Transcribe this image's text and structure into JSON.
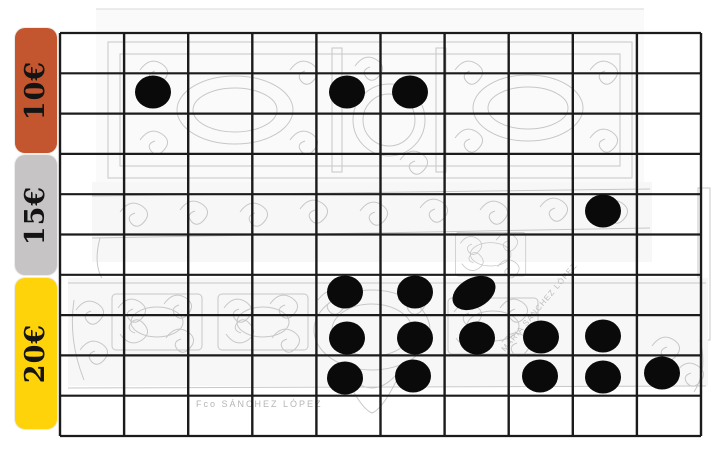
{
  "board": {
    "description": "Price grid board with black token markers placed over faded antique furniture drawings",
    "background_color": "#ffffff",
    "grid_line_color": "#1b1b1b",
    "token_color": "#0a0a0a",
    "grid": {
      "columns": 10,
      "rows": 10
    },
    "tiers": [
      {
        "id": "tier-10",
        "label": "10€",
        "color": "#c3552f",
        "text_color": "#141414",
        "row_span": "rows 1-3"
      },
      {
        "id": "tier-15",
        "label": "15€",
        "color": "#c6c4c5",
        "text_color": "#141414",
        "row_span": "rows 4-6"
      },
      {
        "id": "tier-20",
        "label": "20€",
        "color": "#ffd30a",
        "text_color": "#141414",
        "row_span": "rows 7-10"
      }
    ],
    "token_count": 17,
    "tokens": [
      {
        "tier": "10€",
        "col": 2,
        "row": 2,
        "x": 153,
        "y": 92
      },
      {
        "tier": "10€",
        "col": 5,
        "row": 2,
        "x": 347,
        "y": 92
      },
      {
        "tier": "10€",
        "col": 6,
        "row": 2,
        "x": 410,
        "y": 92
      },
      {
        "tier": "15€",
        "col": 9,
        "row": 5,
        "x": 603,
        "y": 211
      },
      {
        "tier": "20€",
        "col": 5,
        "row": 7,
        "x": 345,
        "y": 292
      },
      {
        "tier": "20€",
        "col": 6,
        "row": 7,
        "x": 415,
        "y": 292
      },
      {
        "tier": "20€",
        "col": 7,
        "row": 7,
        "x": 474,
        "y": 293,
        "tilt": -28,
        "rx": 23,
        "ry": 15
      },
      {
        "tier": "20€",
        "col": 5,
        "row": 8,
        "x": 347,
        "y": 338
      },
      {
        "tier": "20€",
        "col": 6,
        "row": 8,
        "x": 415,
        "y": 338
      },
      {
        "tier": "20€",
        "col": 7,
        "row": 8,
        "x": 477,
        "y": 338
      },
      {
        "tier": "20€",
        "col": 8,
        "row": 8,
        "x": 541,
        "y": 337
      },
      {
        "tier": "20€",
        "col": 9,
        "row": 8,
        "x": 603,
        "y": 336
      },
      {
        "tier": "20€",
        "col": 5,
        "row": 9,
        "x": 345,
        "y": 378
      },
      {
        "tier": "20€",
        "col": 6,
        "row": 9,
        "x": 413,
        "y": 376
      },
      {
        "tier": "20€",
        "col": 8,
        "row": 9,
        "x": 540,
        "y": 376
      },
      {
        "tier": "20€",
        "col": 9,
        "row": 9,
        "x": 603,
        "y": 377
      },
      {
        "tier": "20€",
        "col": 10,
        "row": 9,
        "x": 662,
        "y": 373
      }
    ],
    "watermarks": {
      "signature": "Fco SÁNCHEZ LÓPEZ",
      "stamp": "MARIA SÁNCHEZ LÓPEZ"
    }
  }
}
